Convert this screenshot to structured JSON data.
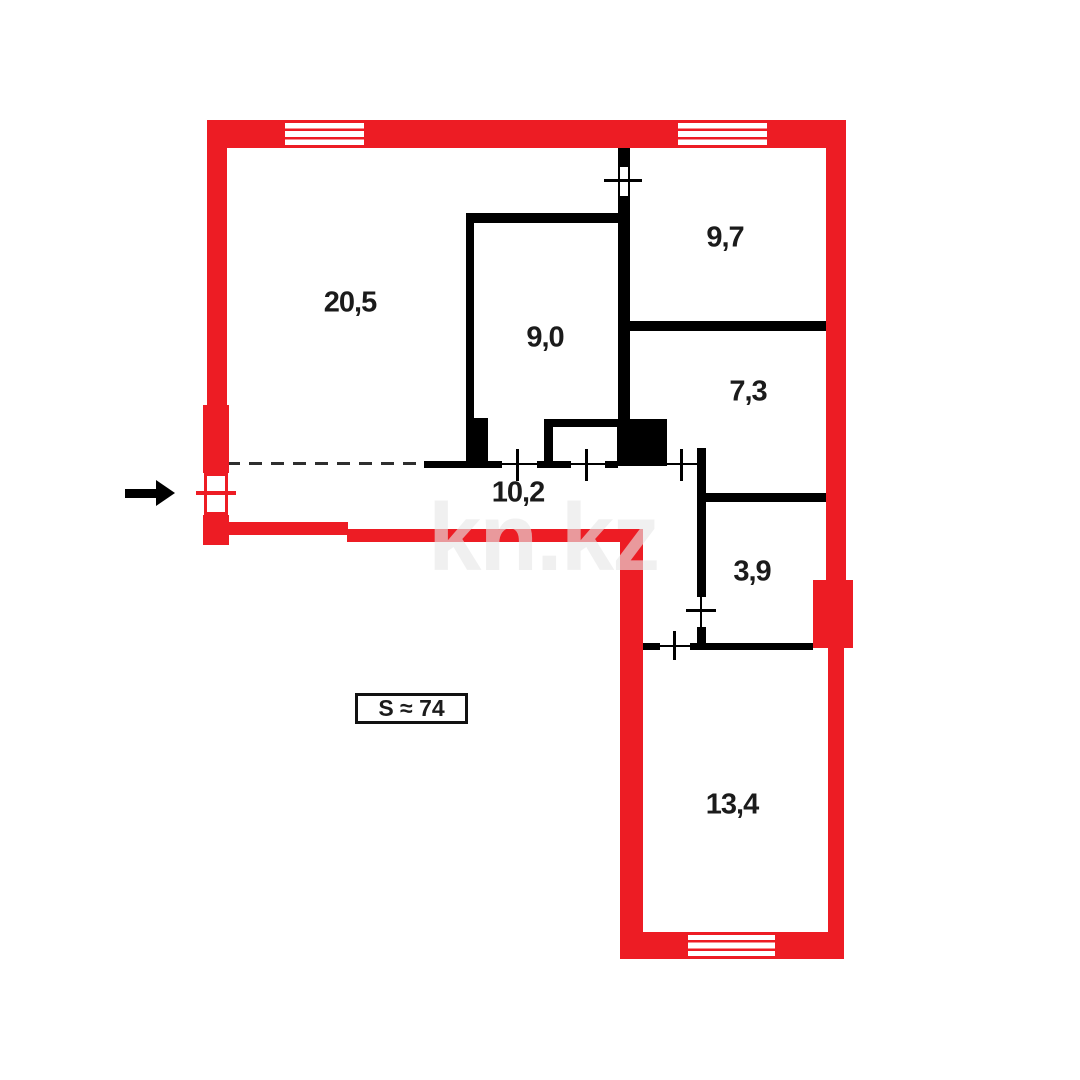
{
  "floorplan": {
    "watermark": "kn.kz",
    "area_label": "S ≈ 74",
    "rooms": [
      {
        "label": "20,5"
      },
      {
        "label": "9,0"
      },
      {
        "label": "9,7"
      },
      {
        "label": "7,3"
      },
      {
        "label": "10,2"
      },
      {
        "label": "3,9"
      },
      {
        "label": "13,4"
      }
    ],
    "colors": {
      "exterior_wall": "#ed1c24",
      "interior_wall": "#000000",
      "text": "#1b1b1b",
      "watermark": "rgba(230,230,230,0.62)"
    }
  }
}
